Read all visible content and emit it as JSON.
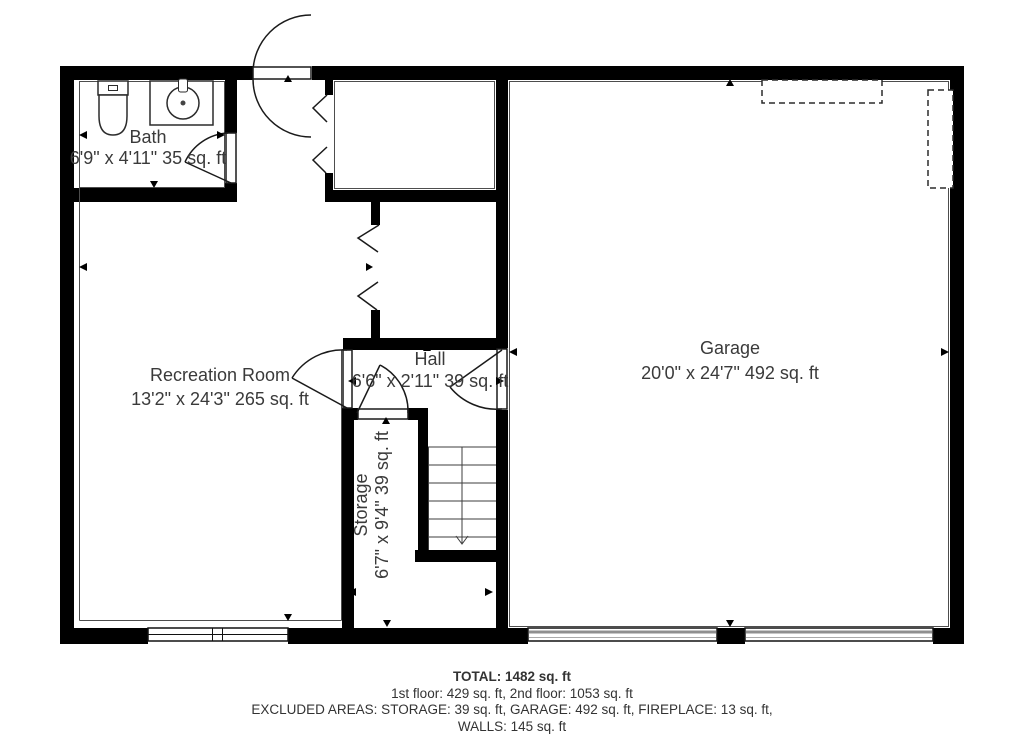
{
  "rooms": {
    "bath": {
      "name": "Bath",
      "dims": "6'9\" x 4'11\" 35 sq. ft"
    },
    "recreation_room": {
      "name": "Recreation Room",
      "dims": "13'2\" x 24'3\" 265 sq. ft"
    },
    "hall": {
      "name": "Hall",
      "dims": "6'6\" x 2'11\" 39 sq. ft"
    },
    "storage": {
      "name": "Storage",
      "dims": "6'7\" x 9'4\" 39 sq. ft"
    },
    "garage": {
      "name": "Garage",
      "dims": "20'0\" x 24'7\" 492 sq. ft"
    }
  },
  "summary": {
    "total": "TOTAL: 1482 sq. ft",
    "floors": "1st floor: 429 sq. ft, 2nd floor: 1053 sq. ft",
    "excluded": "EXCLUDED AREAS: STORAGE: 39 sq. ft, GARAGE: 492 sq. ft, FIREPLACE: 13 sq. ft,",
    "walls": "WALLS: 145 sq. ft"
  },
  "colors": {
    "wall": "#000000",
    "text": "#3a3a3a",
    "background": "#ffffff"
  }
}
